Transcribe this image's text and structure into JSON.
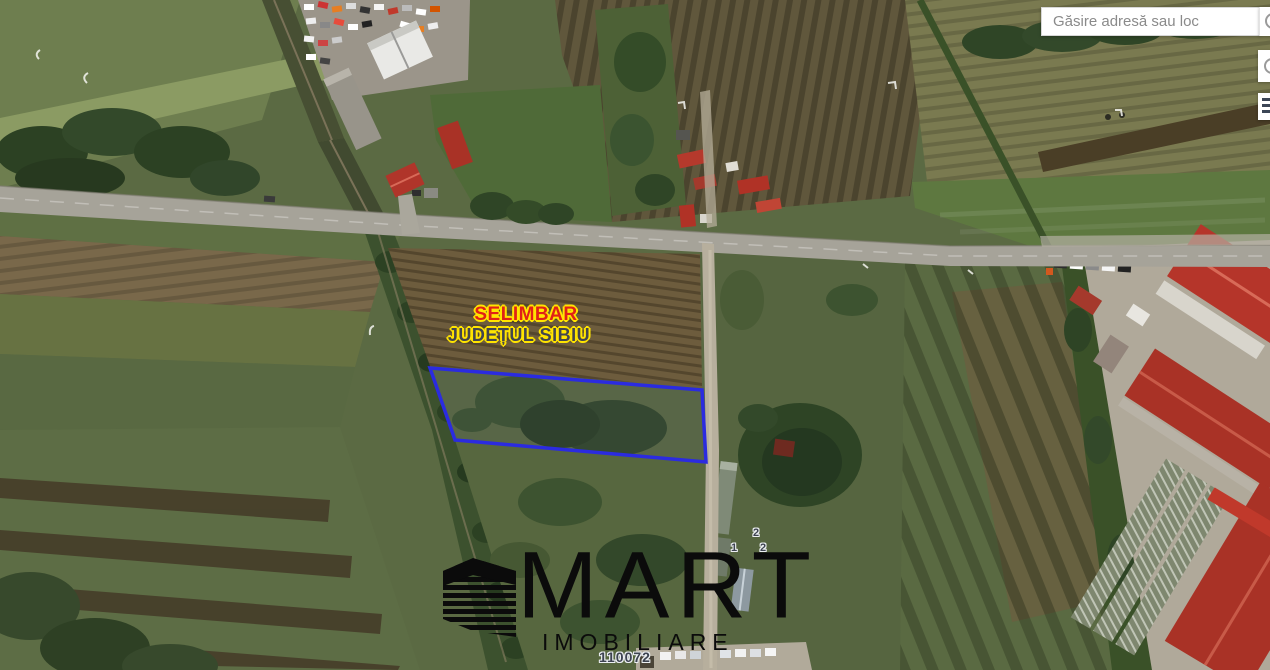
{
  "map_overlay": {
    "place_label": {
      "line1": "SELIMBAR",
      "line2": "JUDEȚUL SIBIU",
      "line1_color": "#e02117",
      "line2_color": "#43464f",
      "outline_color": "#ffe400"
    },
    "parcel_number": "110072",
    "cadastral_markers": [
      {
        "text": "2"
      },
      {
        "text": "1"
      },
      {
        "text": "2"
      }
    ],
    "parcel_outline_color": "#2b2be0"
  },
  "watermark": {
    "brand": "MART",
    "tagline": "IMOBILIARE",
    "icon": "building-logo-icon",
    "color": "#0b0b0b"
  },
  "search": {
    "placeholder": "Găsire adresă sau loc",
    "buttons": [
      {
        "icon": "search-icon"
      },
      {
        "icon": "search-icon"
      },
      {
        "icon": "layers-icon"
      }
    ]
  }
}
